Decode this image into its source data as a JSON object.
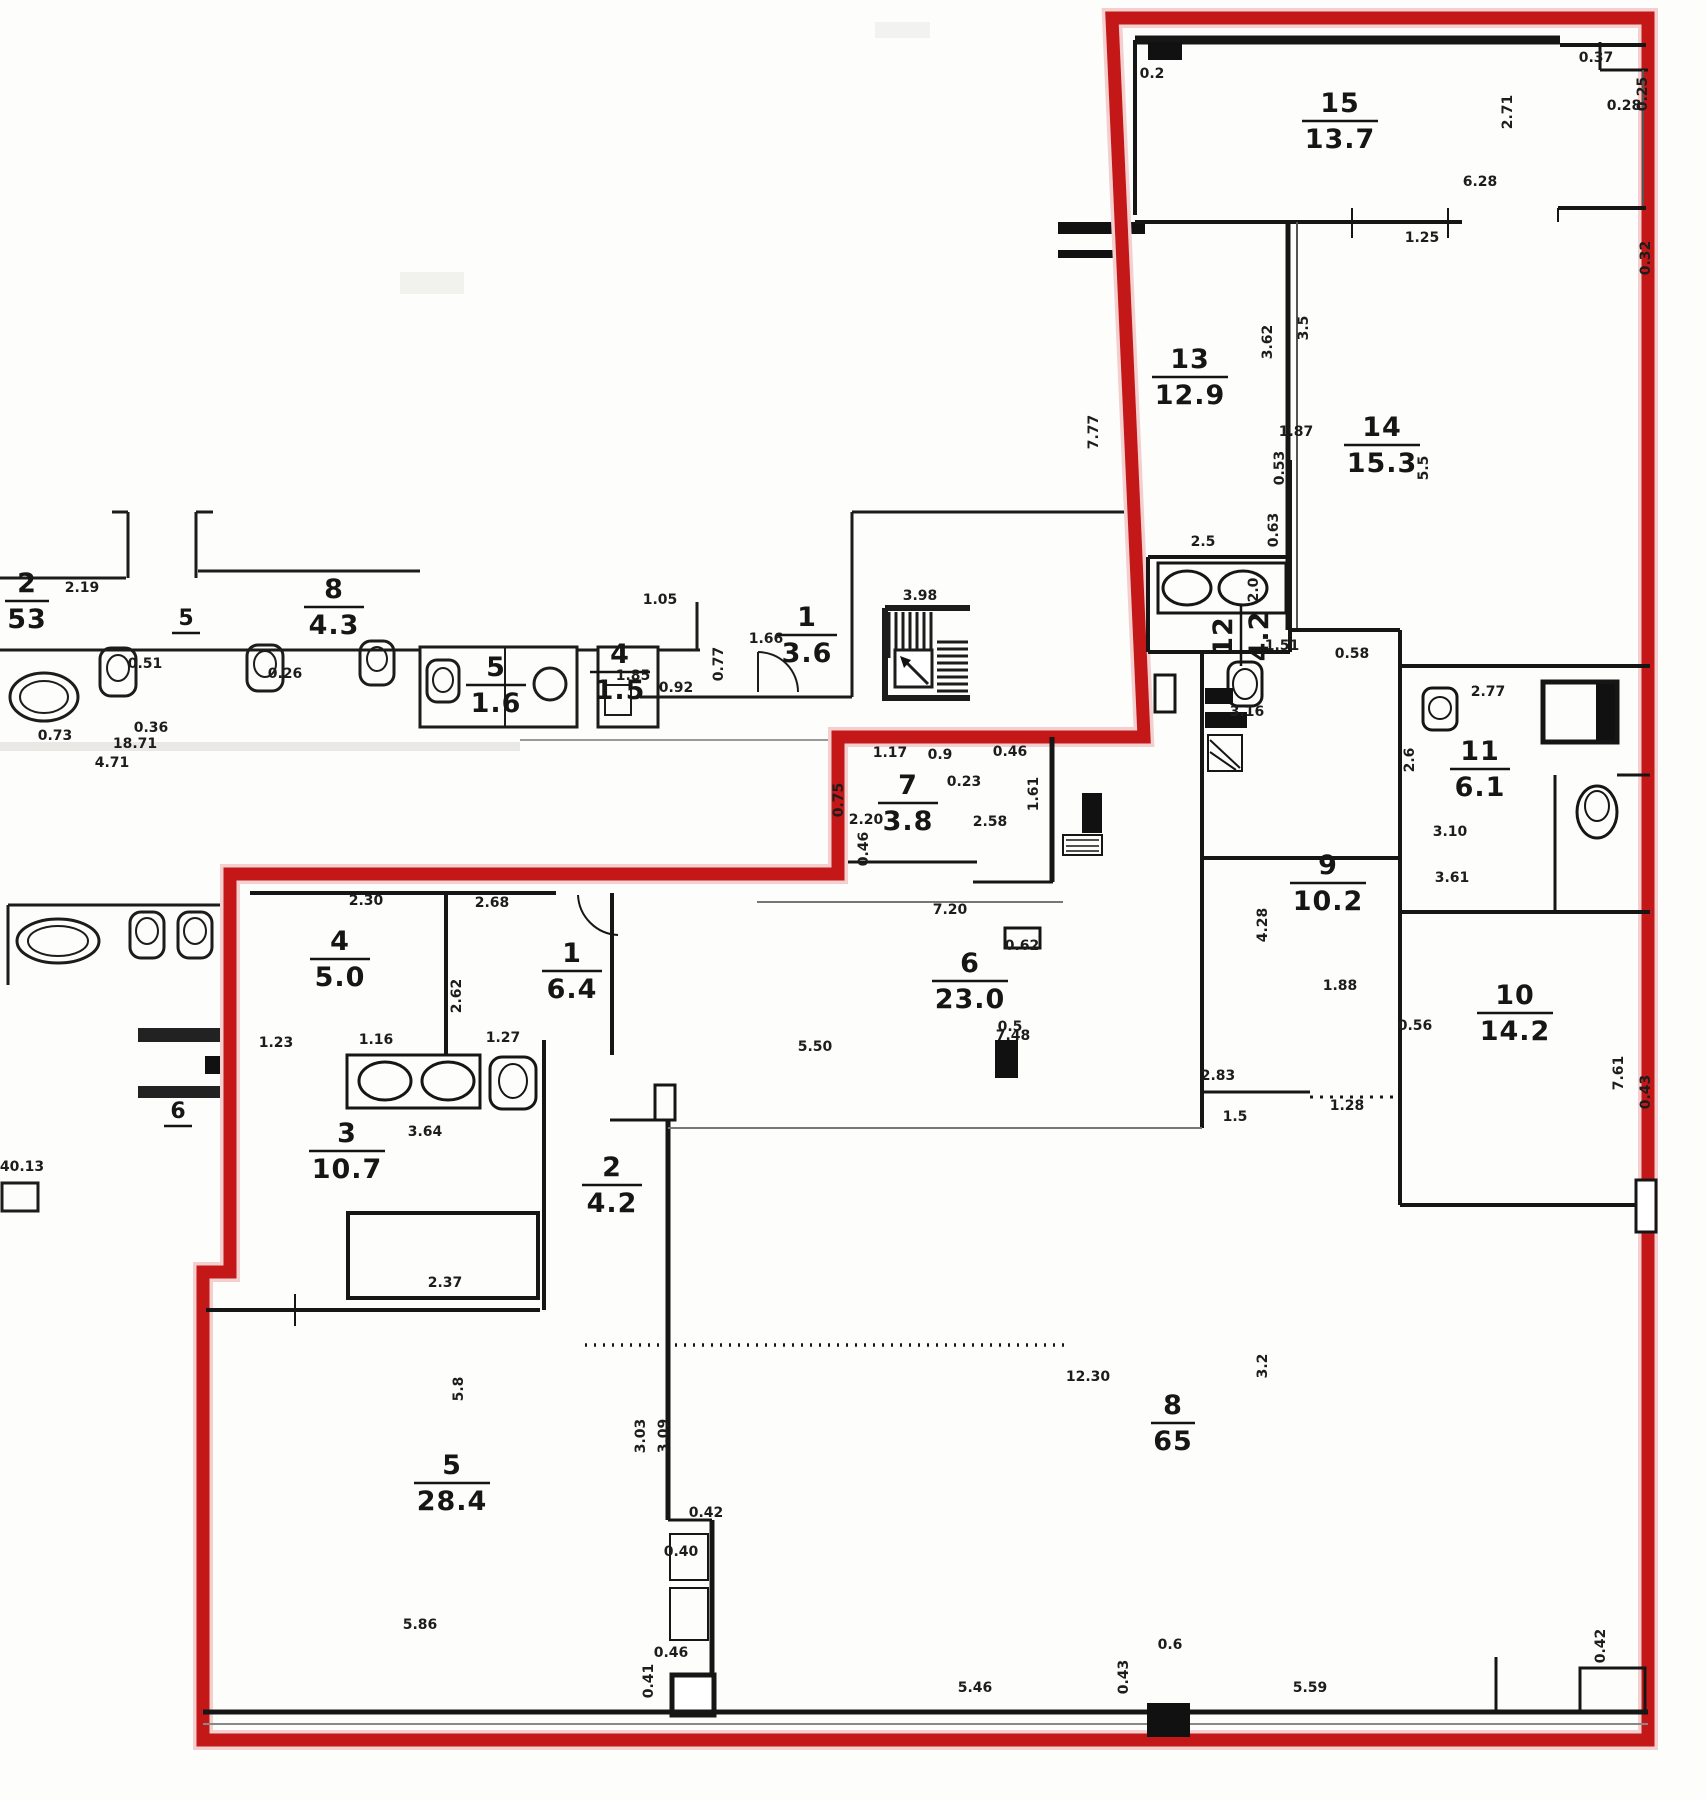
{
  "title": "Scanned apartment floor plan with red unit boundary",
  "boundary": {
    "color": "#c41818",
    "halo": "#f3cfcf"
  },
  "rooms": [
    {
      "num": "15",
      "area": "13.7",
      "x": 1340,
      "y": 112
    },
    {
      "num": "13",
      "area": "12.9",
      "x": 1190,
      "y": 368
    },
    {
      "num": "14",
      "area": "15.3",
      "x": 1382,
      "y": 436
    },
    {
      "num": "12",
      "area": "4.2",
      "x": 1232,
      "y": 636,
      "rot": -90
    },
    {
      "num": "11",
      "area": "6.1",
      "x": 1480,
      "y": 760
    },
    {
      "num": "9",
      "area": "10.2",
      "x": 1328,
      "y": 874
    },
    {
      "num": "10",
      "area": "14.2",
      "x": 1515,
      "y": 1004
    },
    {
      "num": "7",
      "area": "3.8",
      "x": 908,
      "y": 794
    },
    {
      "num": "6",
      "area": "23.0",
      "x": 970,
      "y": 972
    },
    {
      "num": "4",
      "area": "5.0",
      "x": 340,
      "y": 950
    },
    {
      "num": "1",
      "area": "6.4",
      "x": 572,
      "y": 962
    },
    {
      "num": "3",
      "area": "10.7",
      "x": 347,
      "y": 1142
    },
    {
      "num": "2",
      "area": "4.2",
      "x": 612,
      "y": 1176
    },
    {
      "num": "5",
      "area": "28.4",
      "x": 452,
      "y": 1474
    },
    {
      "num": "8",
      "area": "65",
      "x": 1173,
      "y": 1414
    },
    {
      "num": "2",
      "area": "53",
      "x": 27,
      "y": 592
    },
    {
      "num": "8",
      "area": "4.3",
      "x": 334,
      "y": 598
    },
    {
      "num": "5",
      "area": "1.6",
      "x": 496,
      "y": 676
    },
    {
      "num": "4",
      "area": "1.5",
      "x": 620,
      "y": 663
    },
    {
      "num": "1",
      "area": "3.6",
      "x": 807,
      "y": 626
    }
  ],
  "small_labels": [
    {
      "t": "6",
      "x": 178,
      "y": 1118
    },
    {
      "t": "5",
      "x": 186,
      "y": 625
    }
  ],
  "dims": [
    {
      "t": "6.28",
      "x": 1480,
      "y": 186
    },
    {
      "t": "2.71",
      "x": 1512,
      "y": 112,
      "r": -90
    },
    {
      "t": "0.37",
      "x": 1596,
      "y": 62
    },
    {
      "t": "0.25",
      "x": 1647,
      "y": 94,
      "r": -90
    },
    {
      "t": "0.28",
      "x": 1624,
      "y": 110
    },
    {
      "t": "0.32",
      "x": 1650,
      "y": 258,
      "r": -90
    },
    {
      "t": "1.25",
      "x": 1422,
      "y": 242
    },
    {
      "t": "0.2",
      "x": 1152,
      "y": 78
    },
    {
      "t": "3.62",
      "x": 1272,
      "y": 342,
      "r": -90
    },
    {
      "t": "3.5",
      "x": 1308,
      "y": 328,
      "r": -90
    },
    {
      "t": "7.77",
      "x": 1098,
      "y": 432,
      "r": -90
    },
    {
      "t": "5.5",
      "x": 1428,
      "y": 468,
      "r": -90
    },
    {
      "t": "1.87",
      "x": 1296,
      "y": 436
    },
    {
      "t": "0.53",
      "x": 1284,
      "y": 468,
      "r": -90
    },
    {
      "t": "2.5",
      "x": 1203,
      "y": 546
    },
    {
      "t": "0.63",
      "x": 1278,
      "y": 530,
      "r": -90
    },
    {
      "t": "2.0",
      "x": 1258,
      "y": 590,
      "r": -90
    },
    {
      "t": "1.51",
      "x": 1282,
      "y": 650
    },
    {
      "t": "2.77",
      "x": 1488,
      "y": 696
    },
    {
      "t": "0.58",
      "x": 1352,
      "y": 658
    },
    {
      "t": "3.16",
      "x": 1247,
      "y": 716
    },
    {
      "t": "2.6",
      "x": 1414,
      "y": 760,
      "r": -90
    },
    {
      "t": "3.10",
      "x": 1450,
      "y": 836
    },
    {
      "t": "3.61",
      "x": 1452,
      "y": 882
    },
    {
      "t": "4.28",
      "x": 1267,
      "y": 925,
      "r": -90
    },
    {
      "t": "1.88",
      "x": 1340,
      "y": 990
    },
    {
      "t": "0.56",
      "x": 1415,
      "y": 1030
    },
    {
      "t": "2.83",
      "x": 1218,
      "y": 1080
    },
    {
      "t": "1.28",
      "x": 1347,
      "y": 1110
    },
    {
      "t": "1.5",
      "x": 1235,
      "y": 1121
    },
    {
      "t": "7.61",
      "x": 1623,
      "y": 1073,
      "r": -90
    },
    {
      "t": "0.43",
      "x": 1650,
      "y": 1092,
      "r": -90
    },
    {
      "t": "0.75",
      "x": 843,
      "y": 800,
      "r": -90
    },
    {
      "t": "2.20",
      "x": 866,
      "y": 824
    },
    {
      "t": "0.23",
      "x": 964,
      "y": 786
    },
    {
      "t": "1.17",
      "x": 890,
      "y": 757
    },
    {
      "t": "0.9",
      "x": 940,
      "y": 759
    },
    {
      "t": "0.46",
      "x": 1010,
      "y": 756
    },
    {
      "t": "2.58",
      "x": 990,
      "y": 826
    },
    {
      "t": "1.61",
      "x": 1038,
      "y": 794,
      "r": -90
    },
    {
      "t": "0.46",
      "x": 868,
      "y": 849,
      "r": -90
    },
    {
      "t": "7.20",
      "x": 950,
      "y": 914
    },
    {
      "t": "7.48",
      "x": 1013,
      "y": 1040
    },
    {
      "t": "0.62",
      "x": 1022,
      "y": 950
    },
    {
      "t": "0.5",
      "x": 1010,
      "y": 1031
    },
    {
      "t": "5.50",
      "x": 815,
      "y": 1051
    },
    {
      "t": "2.30",
      "x": 366,
      "y": 905
    },
    {
      "t": "2.68",
      "x": 492,
      "y": 907
    },
    {
      "t": "2.62",
      "x": 461,
      "y": 996,
      "r": -90
    },
    {
      "t": "1.23",
      "x": 276,
      "y": 1047
    },
    {
      "t": "1.16",
      "x": 376,
      "y": 1044
    },
    {
      "t": "1.27",
      "x": 503,
      "y": 1042
    },
    {
      "t": "3.64",
      "x": 425,
      "y": 1136
    },
    {
      "t": "2.37",
      "x": 445,
      "y": 1287
    },
    {
      "t": "3.03",
      "x": 645,
      "y": 1436,
      "r": -90
    },
    {
      "t": "3.09",
      "x": 668,
      "y": 1436,
      "r": -90
    },
    {
      "t": "5.8",
      "x": 463,
      "y": 1389,
      "r": -90
    },
    {
      "t": "5.86",
      "x": 420,
      "y": 1629
    },
    {
      "t": "0.42",
      "x": 706,
      "y": 1517
    },
    {
      "t": "0.40",
      "x": 681,
      "y": 1556
    },
    {
      "t": "0.46",
      "x": 671,
      "y": 1657
    },
    {
      "t": "0.41",
      "x": 653,
      "y": 1681,
      "r": -90
    },
    {
      "t": "12.30",
      "x": 1088,
      "y": 1381
    },
    {
      "t": "3.2",
      "x": 1267,
      "y": 1366,
      "r": -90
    },
    {
      "t": "5.46",
      "x": 975,
      "y": 1692
    },
    {
      "t": "0.43",
      "x": 1128,
      "y": 1677,
      "r": -90
    },
    {
      "t": "0.6",
      "x": 1170,
      "y": 1649
    },
    {
      "t": "5.59",
      "x": 1310,
      "y": 1692
    },
    {
      "t": "0.42",
      "x": 1605,
      "y": 1646,
      "r": -90
    },
    {
      "t": "18.71",
      "x": 135,
      "y": 748
    },
    {
      "t": "4.71",
      "x": 112,
      "y": 767
    },
    {
      "t": "0.73",
      "x": 55,
      "y": 740
    },
    {
      "t": "2.19",
      "x": 82,
      "y": 592
    },
    {
      "t": "0.51",
      "x": 145,
      "y": 668
    },
    {
      "t": "0.26",
      "x": 285,
      "y": 678
    },
    {
      "t": "0.36",
      "x": 151,
      "y": 732
    },
    {
      "t": "0.92",
      "x": 676,
      "y": 692
    },
    {
      "t": "0.77",
      "x": 723,
      "y": 664,
      "r": -90
    },
    {
      "t": "1.85",
      "x": 633,
      "y": 680
    },
    {
      "t": "1.66",
      "x": 766,
      "y": 643
    },
    {
      "t": "1.05",
      "x": 660,
      "y": 604
    },
    {
      "t": "3.98",
      "x": 920,
      "y": 600
    },
    {
      "t": "40.13",
      "x": 22,
      "y": 1171
    }
  ]
}
